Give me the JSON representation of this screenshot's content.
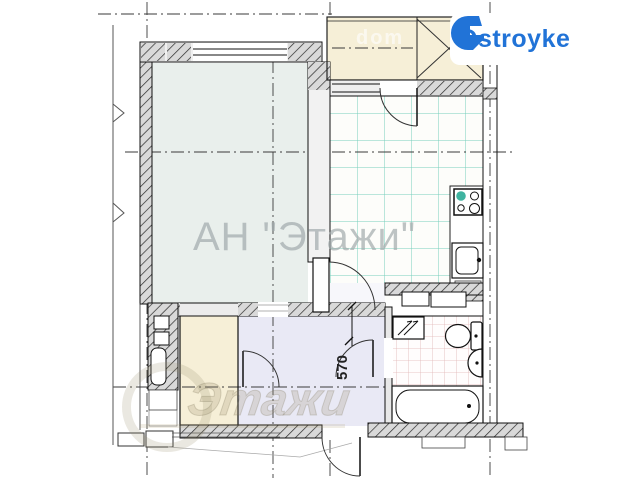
{
  "logo": {
    "text": "Ostroyke"
  },
  "watermarks": {
    "center": "АН \"Этажи\"",
    "balcony": "dom",
    "bottom": "Этажи"
  },
  "plan": {
    "dimension_label": "570"
  },
  "colors": {
    "accent_blue": "#2173d7",
    "living_room_fill": "#e9efec",
    "kitchen_grid": "#5fc6b2",
    "bathroom_grid": "#ddaeae",
    "balcony_fill": "#f6efd7",
    "storage_fill": "#f6efd7",
    "hallway_fill": "#e9e9f5",
    "wall_fill": "#d9d9d9"
  }
}
